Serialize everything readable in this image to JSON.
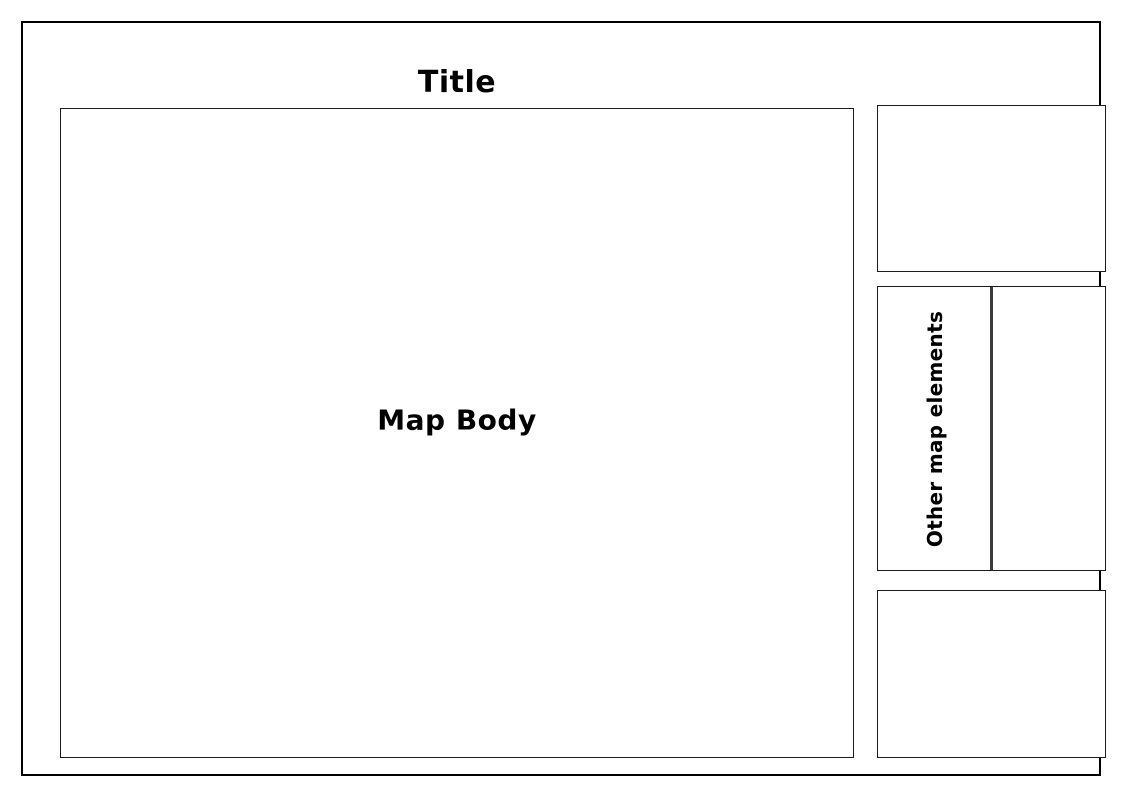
{
  "figure": {
    "title": "Title",
    "map_body_label": "Map Body",
    "other_map_elements_label": "Other map elements"
  },
  "colors": {
    "background": "#ffffff",
    "frame-border": "#000000",
    "box-border": "#1c1c1c",
    "divider": "#3c3c3c",
    "text": "#000000"
  }
}
